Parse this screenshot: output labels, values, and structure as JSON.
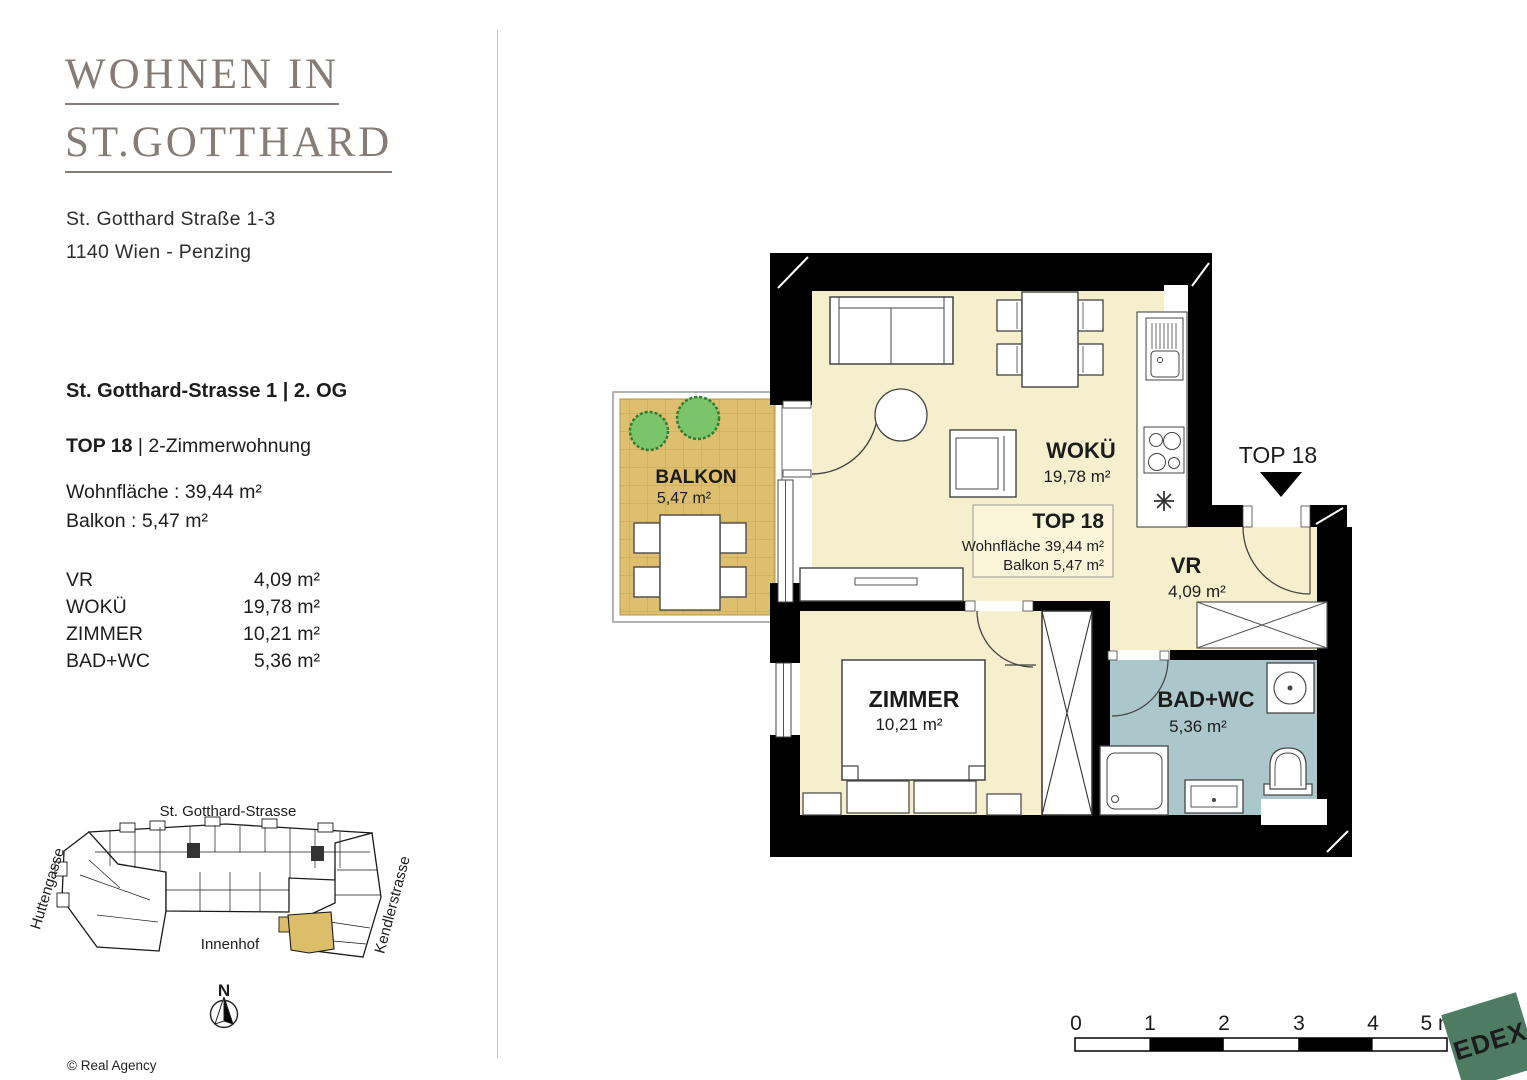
{
  "header": {
    "title_line1": "WOHNEN IN",
    "title_line2": "ST.GOTTHARD",
    "address_line1": "St. Gotthard Straße 1-3",
    "address_line2": "1140 Wien - Penzing"
  },
  "details": {
    "location": "St. Gotthard-Strasse 1 | 2. OG",
    "unit_bold": "TOP 18",
    "unit_rest": " | 2-Zimmerwohnung",
    "living_area": "Wohnfläche : 39,44 m²",
    "balcony_area": "Balkon : 5,47 m²",
    "rooms": [
      {
        "name": "VR",
        "area": "4,09 m²"
      },
      {
        "name": "WOKÜ",
        "area": "19,78 m²"
      },
      {
        "name": "ZIMMER",
        "area": "10,21 m²"
      },
      {
        "name": "BAD+WC",
        "area": "5,36 m²"
      }
    ]
  },
  "floor_plan": {
    "balkon_label": "BALKON",
    "balkon_area": "5,47 m²",
    "woku_label": "WOKÜ",
    "woku_area": "19,78 m²",
    "vr_label": "VR",
    "vr_area": "4,09 m²",
    "zimmer_label": "ZIMMER",
    "zimmer_area": "10,21 m²",
    "bad_label": "BAD+WC",
    "bad_area": "5,36 m²",
    "entrance_label": "TOP 18",
    "info_box": {
      "title": "TOP 18",
      "line1": "Wohnfläche 39,44 m²",
      "line2": "Balkon 5,47 m²"
    }
  },
  "site_plan": {
    "street_top": "St. Gotthard-Strasse",
    "street_left": "Huttengasse",
    "street_right": "Kendlerstrasse",
    "courtyard": "Innenhof",
    "north": "N"
  },
  "scale_bar": {
    "labels": [
      "0",
      "1",
      "2",
      "3",
      "4",
      "5 m"
    ]
  },
  "footer": {
    "copyright": "© Real Agency"
  },
  "logo": {
    "text": "EDEX"
  },
  "colors": {
    "cream": "#f5efcd",
    "balcony_tan": "#ddbf6f",
    "bath_blue": "#abc7cb",
    "wall_black": "#000000",
    "logo_green": "#4d7c63",
    "title_gray": "#857c77",
    "highlight_tan": "#dcbd6a"
  }
}
